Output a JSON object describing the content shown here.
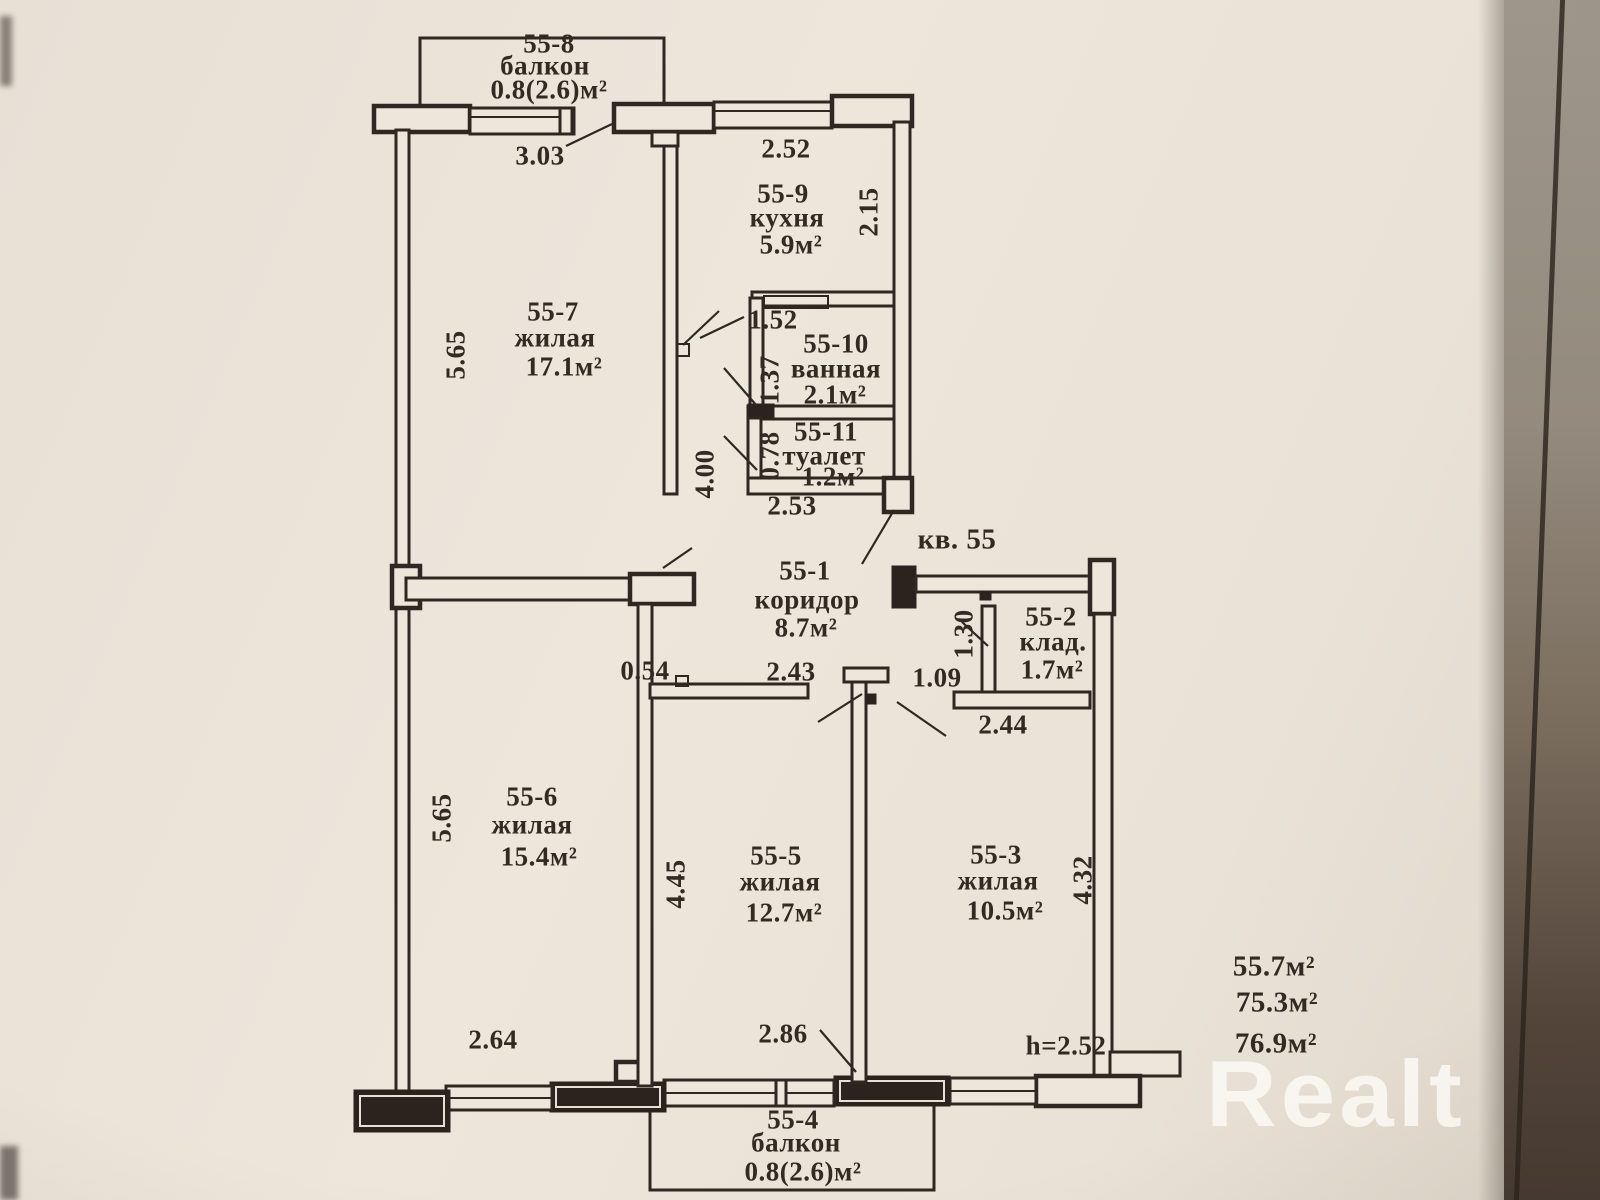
{
  "photo": {
    "paper_color": "#ece6db",
    "line_color": "#2f2822",
    "watermark_color": "rgba(253,251,246,0.8)"
  },
  "watermark": {
    "brand": "Realt"
  },
  "apartment": {
    "number_label": "кв. 55",
    "ceiling_height": "h=2.52",
    "areas_summary": [
      "55.7м²",
      "75.3м²",
      "76.9м²"
    ]
  },
  "rooms": [
    {
      "id": "55-8",
      "name": "балкон",
      "area": "0.8(2.6)м²"
    },
    {
      "id": "55-9",
      "name": "кухня",
      "area": "5.9м²"
    },
    {
      "id": "55-7",
      "name": "жилая",
      "area": "17.1м²"
    },
    {
      "id": "55-10",
      "name": "ванная",
      "area": "2.1м²"
    },
    {
      "id": "55-11",
      "name": "туалет",
      "area": "1.2м²"
    },
    {
      "id": "55-1",
      "name": "коридор",
      "area": "8.7м²"
    },
    {
      "id": "55-2",
      "name": "клад.",
      "area": "1.7м²"
    },
    {
      "id": "55-6",
      "name": "жилая",
      "area": "15.4м²"
    },
    {
      "id": "55-5",
      "name": "жилая",
      "area": "12.7м²"
    },
    {
      "id": "55-3",
      "name": "жилая",
      "area": "10.5м²"
    },
    {
      "id": "55-4",
      "name": "балкон",
      "area": "0.8(2.6)м²"
    }
  ],
  "dims": {
    "balcony_top_width": "3.03",
    "kitchen_width": "2.52",
    "kitchen_depth": "2.15",
    "room7_depth": "5.65",
    "bath_width": "1.52",
    "bath_depth": "1.37",
    "wc_depth": "0.78",
    "partition_len": "4.00",
    "corridor_width": "2.53",
    "wall_stub": "0.54",
    "room5_top_width": "2.43",
    "entry_width": "1.09",
    "storage_depth": "1.30",
    "storage_width": "2.44",
    "room5_depth": "4.45",
    "room6_depth": "5.65",
    "room6_width": "2.64",
    "room5_bottom_width": "2.86",
    "room3_depth": "4.32"
  }
}
